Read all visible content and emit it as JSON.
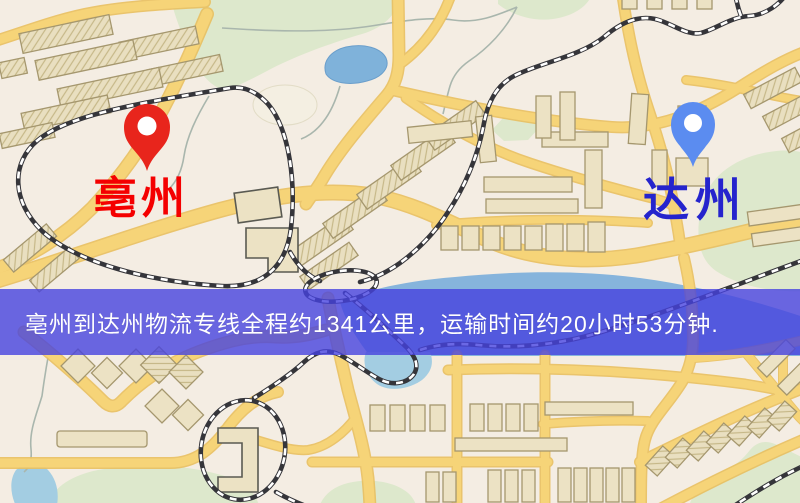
{
  "banner": {
    "text": "亳州到达州物流专线全程约1341公里，运输时间约20小时53分钟.",
    "background_color": "#4642de",
    "text_color": "#ffffff",
    "distance_text": "约1341公里",
    "duration_text": "约20小时53分钟"
  },
  "markers": {
    "origin": {
      "name": "亳州",
      "pin_color": "#e8251c",
      "label_color": "#f40000"
    },
    "destination": {
      "name": "达州",
      "pin_color": "#5b8cf0",
      "label_color": "#2524cd"
    }
  },
  "map": {
    "background_color": "#f4ede3",
    "road_color": "#f6d478",
    "road_casing_color": "#e9c060",
    "park_color": "#dde8cc",
    "water_color": "#7fb2da",
    "river_color": "#86b4dc",
    "building_color": "#ece2c4",
    "building_stroke_color": "#a5976e",
    "railway_color": "#35353a",
    "stream_color": "#a9b6ad"
  }
}
